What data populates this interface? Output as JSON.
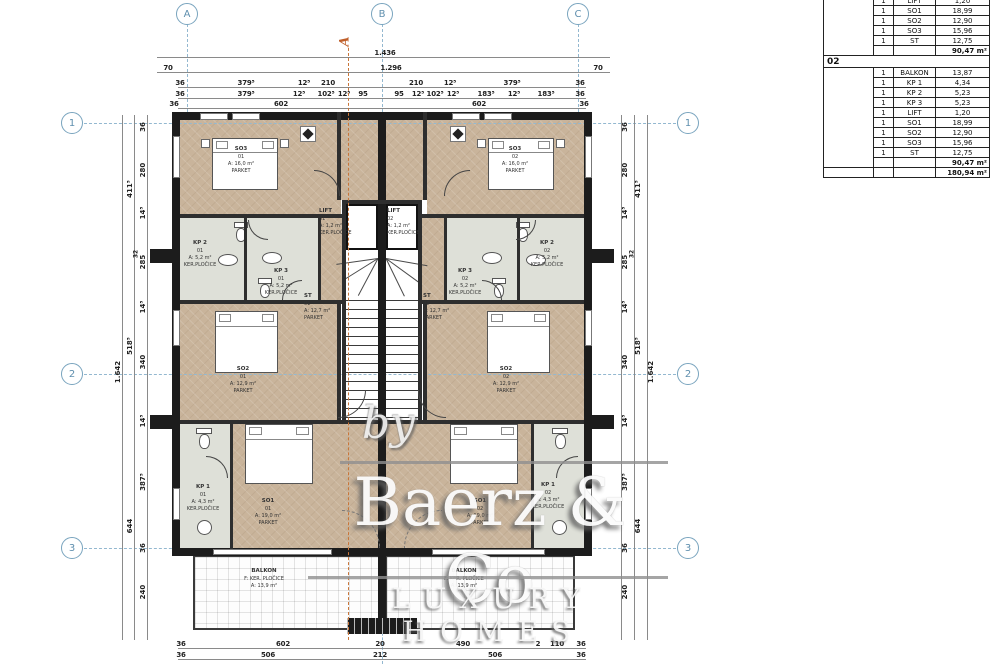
{
  "colors": {
    "parket": "#c9b49b",
    "tile": "#dee0d8",
    "wall": "#1c1c1c",
    "grid_blue": "#93b8d0",
    "section_orange": "#c8763a",
    "bubble_blue": "#79a4be"
  },
  "grid": {
    "top": [
      "A",
      "B",
      "C"
    ],
    "side": [
      "1",
      "2",
      "3"
    ]
  },
  "section_marker": "A",
  "dims": {
    "t1": [
      "1.436"
    ],
    "t2": [
      "70",
      "1.296",
      "70"
    ],
    "t3": [
      "36",
      "379⁵",
      "12⁵",
      "210",
      "210",
      "12⁵",
      "379⁵",
      "36"
    ],
    "t4": [
      "36",
      "379⁵",
      "12⁵",
      "102⁵",
      "12⁵",
      "95",
      "95",
      "12⁵",
      "102⁵",
      "12⁵",
      "183⁵",
      "12⁵",
      "183⁵",
      "36"
    ],
    "t5": [
      "36",
      "602",
      "602",
      "36"
    ],
    "b1": [
      "36",
      "602",
      "20",
      "490",
      "2",
      "110",
      "36"
    ],
    "b2": [
      "36",
      "506",
      "212",
      "506",
      "36"
    ],
    "vi": [
      "36",
      "280",
      "14⁵",
      "32",
      "285",
      "14⁵",
      "340",
      "14⁵",
      "387⁵",
      "36",
      "240"
    ],
    "vm": [
      "411⁵",
      "518⁵",
      "644"
    ],
    "vo": [
      "1.642"
    ]
  },
  "rooms": {
    "so3_1": {
      "name": "SO3",
      "num": "01",
      "area": "A: 16,0 m²",
      "floor": "PARKET"
    },
    "so3_2": {
      "name": "SO3",
      "num": "02",
      "area": "A: 16,0 m²",
      "floor": "PARKET"
    },
    "kp2_1": {
      "name": "KP 2",
      "num": "01",
      "area": "A: 5,2 m²",
      "floor": "KER.PLOČICE"
    },
    "kp2_2": {
      "name": "KP 2",
      "num": "02",
      "area": "A: 5,2 m²",
      "floor": "KER.PLOČICE"
    },
    "kp3_1": {
      "name": "KP 3",
      "num": "01",
      "area": "A: 5,2 m²",
      "floor": "KER.PLOČICE"
    },
    "kp3_2": {
      "name": "KP 3",
      "num": "02",
      "area": "A: 5,2 m²",
      "floor": "KER.PLOČICE"
    },
    "lift_1": {
      "name": "LIFT",
      "num": "01",
      "area": "A: 1,2 m²",
      "floor": "KER.PLOČICE"
    },
    "lift_2": {
      "name": "LIFT",
      "num": "02",
      "area": "A: 1,2 m²",
      "floor": "KER.PLOČICE"
    },
    "st_1": {
      "name": "ST",
      "num": "01",
      "area": "A: 12,7 m²",
      "floor": "PARKET"
    },
    "st_2": {
      "name": "ST",
      "num": "02",
      "area": "A: 12,7 m²",
      "floor": "PARKET"
    },
    "so2_1": {
      "name": "SO2",
      "num": "01",
      "area": "A: 12,9 m²",
      "floor": "PARKET"
    },
    "so2_2": {
      "name": "SO2",
      "num": "02",
      "area": "A: 12,9 m²",
      "floor": "PARKET"
    },
    "so1_1": {
      "name": "SO1",
      "num": "01",
      "area": "A: 19,0 m²",
      "floor": "PARKET"
    },
    "so1_2": {
      "name": "SO1",
      "num": "02",
      "area": "A: 19,0 m²",
      "floor": "PARKET"
    },
    "kp1_1": {
      "name": "KP 1",
      "num": "01",
      "area": "A: 4,3 m²",
      "floor": "KER.PLOČICE"
    },
    "kp1_2": {
      "name": "KP 1",
      "num": "02",
      "area": "A: 4,3 m²",
      "floor": "KER.PLOČICE"
    },
    "balkon_1": {
      "name": "BALKON",
      "floor": "F: KER. PLOČICE",
      "area": "A: 13,9 m²"
    },
    "balkon_2": {
      "name": "BALKON",
      "floor": "F: KER. PLOČICE",
      "area": "A: 13,9 m²"
    }
  },
  "table": {
    "sections": [
      {
        "rows": [
          {
            "qty": "1",
            "name": "LIFT",
            "value": "1,20"
          },
          {
            "qty": "1",
            "name": "SO1",
            "value": "18,99"
          },
          {
            "qty": "1",
            "name": "SO2",
            "value": "12,90"
          },
          {
            "qty": "1",
            "name": "SO3",
            "value": "15,96"
          },
          {
            "qty": "1",
            "name": "ST",
            "value": "12,75"
          }
        ],
        "total": "90,47 m²"
      },
      {
        "header": "02",
        "rows": [
          {
            "qty": "1",
            "name": "BALKON",
            "value": "13,87"
          },
          {
            "qty": "1",
            "name": "KP 1",
            "value": "4,34"
          },
          {
            "qty": "1",
            "name": "KP 2",
            "value": "5,23"
          },
          {
            "qty": "1",
            "name": "KP 3",
            "value": "5,23"
          },
          {
            "qty": "1",
            "name": "LIFT",
            "value": "1,20"
          },
          {
            "qty": "1",
            "name": "SO1",
            "value": "18,99"
          },
          {
            "qty": "1",
            "name": "SO2",
            "value": "12,90"
          },
          {
            "qty": "1",
            "name": "SO3",
            "value": "15,96"
          },
          {
            "qty": "1",
            "name": "ST",
            "value": "12,75"
          }
        ],
        "total": "90,47 m²"
      }
    ],
    "grand_total": "180,94 m²"
  },
  "watermark": {
    "by": "by",
    "brand": "Baerz & Co",
    "tagline": "LUXURY HOMES"
  }
}
